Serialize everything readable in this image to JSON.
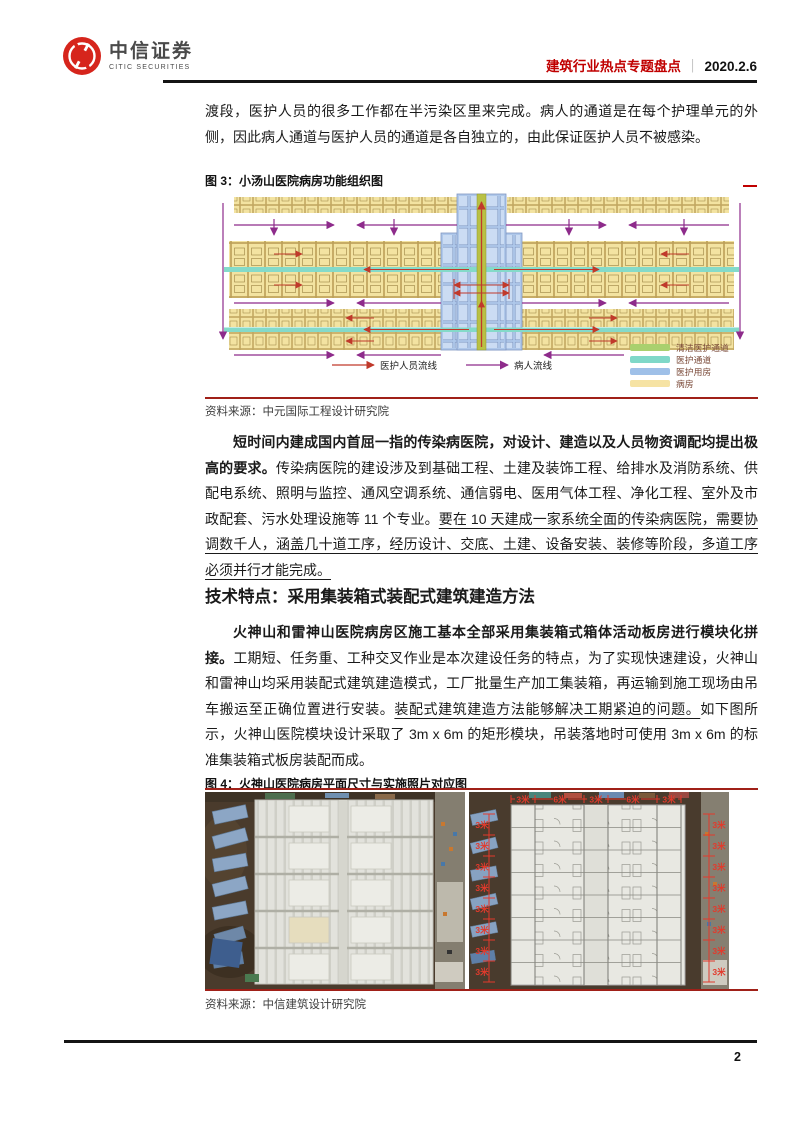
{
  "header": {
    "logo_cn": "中信证券",
    "logo_en": "CITIC SECURITIES",
    "report_title": "建筑行业热点专题盘点",
    "separator": "｜",
    "date": "2020.2.6"
  },
  "paragraphs": {
    "p1": "渡段，医护人员的很多工作都在半污染区里来完成。病人的通道是在每个护理单元的外侧，因此病人通道与医护人员的通道是各自独立的，由此保证医护人员不被感染。",
    "p2_bold": "短时间内建成国内首屈一指的传染病医院，对设计、建造以及人员物资调配均提出极高的要求。",
    "p2_normal": "传染病医院的建设涉及到基础工程、土建及装饰工程、给排水及消防系统、供配电系统、照明与监控、通风空调系统、通信弱电、医用气体工程、净化工程、室外及市政配套、污水处理设施等 11 个专业。",
    "p2_underline": "要在 10 天建成一家系统全面的传染病医院，需要协调数千人，涵盖几十道工序，经历设计、交底、土建、设备安装、装修等阶段，多道工序必须并行才能完成。",
    "section_heading": "技术特点：采用集装箱式装配式建筑建造方法",
    "p3_bold": "火神山和雷神山医院病房区施工基本全部采用集装箱式箱体活动板房进行模块化拼接。",
    "p3_normal1": "工期短、任务重、工种交叉作业是本次建设任务的特点，为了实现快速建设，火神山和雷神山均采用装配式建筑建造模式，工厂批量生产加工集装箱，再运输到施工现场由吊车搬运至正确位置进行安装。",
    "p3_underline": "装配式建筑建造方法能够解决工期紧迫的问题。",
    "p3_normal2": "如下图所示，火神山医院模块设计采取了 3m x 6m 的矩形模块，吊装落地时可使用 3m x 6m 的标准集装箱式板房装配而成。"
  },
  "figure3": {
    "caption": "图 3：小汤山医院病房功能组织图",
    "source": "资料来源：中元国际工程设计研究院",
    "flow_legend": [
      {
        "label": "医护人员流线",
        "color": "#C0392B"
      },
      {
        "label": "病人流线",
        "color": "#8E2B8B"
      }
    ],
    "legend": [
      {
        "label": "清洁医护通道",
        "color": "#A9D06E"
      },
      {
        "label": "医护通道",
        "color": "#7FD8C8"
      },
      {
        "label": "医护用房",
        "color": "#9FC0E8"
      },
      {
        "label": "病房",
        "color": "#F6E3A4"
      }
    ]
  },
  "figure4": {
    "caption": "图 4：火神山医院病房平面尺寸与实施照片对应图",
    "source": "资料来源：中信建筑设计研究院",
    "dims_top": [
      "3米",
      "6米",
      "3米",
      "6米",
      "3米"
    ],
    "dim_side": "3米"
  },
  "footer": {
    "page_number": "2"
  },
  "colors": {
    "title_red": "#C00000",
    "figure_rule_red": "#A02018",
    "logo_red": "#D6251C"
  }
}
